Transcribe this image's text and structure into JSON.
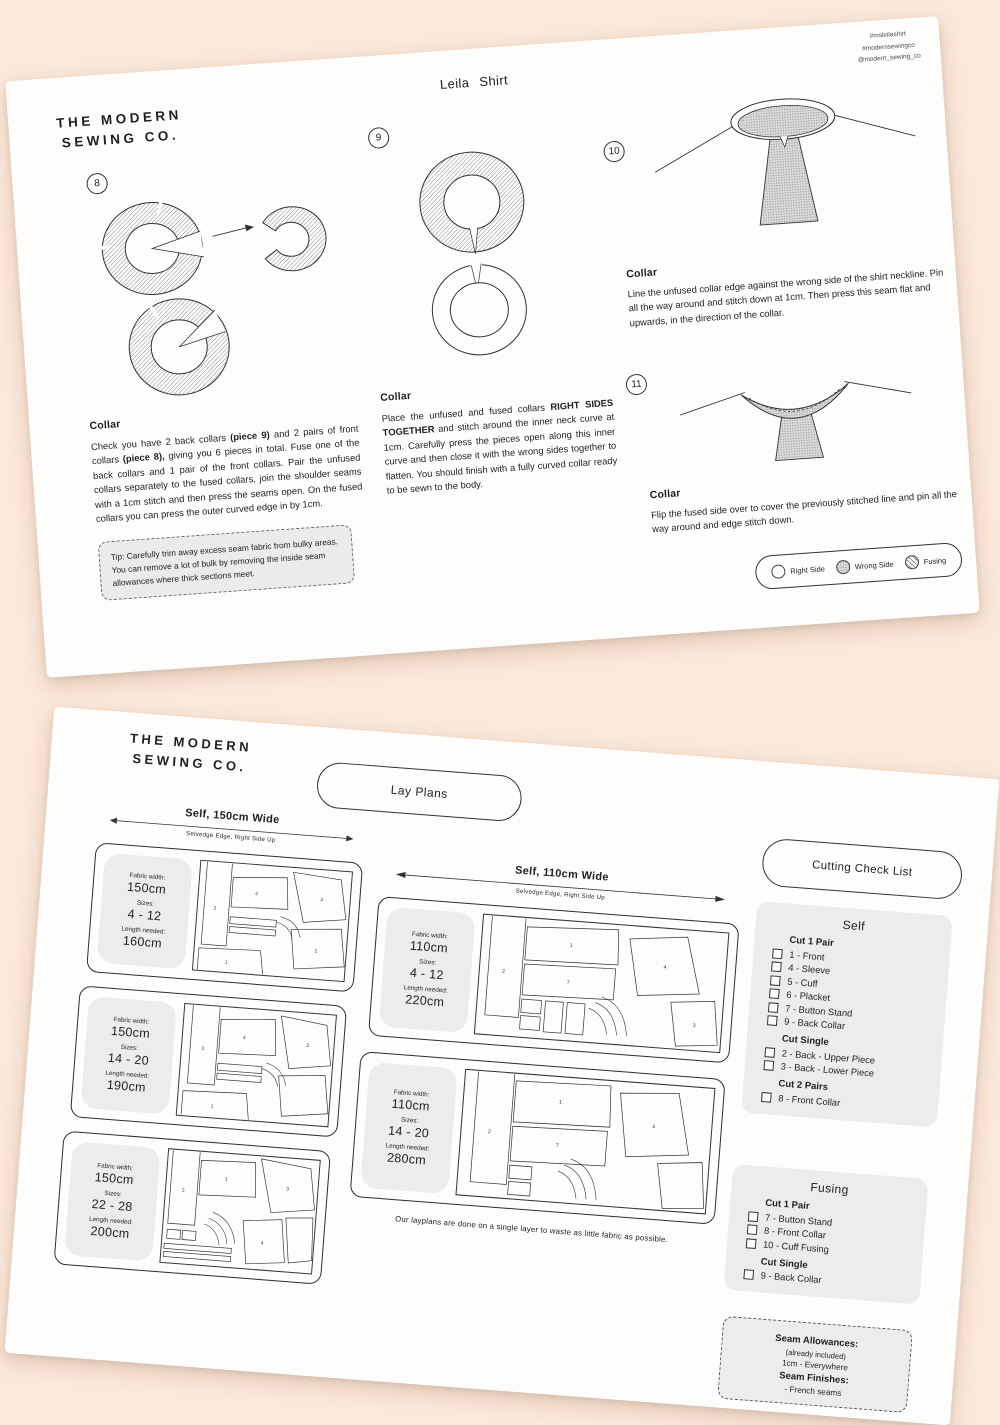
{
  "page1": {
    "social": {
      "l1": "#msleilashirt",
      "l2": "#modernsewingco",
      "l3": "@modern_sewing_co"
    },
    "logo": {
      "line1": "THE MODERN",
      "line2": "SEWING CO."
    },
    "title": "Leila Shirt",
    "steps": {
      "s8": {
        "number": "8",
        "heading": "Collar",
        "t1": "Check you have 2 back collars ",
        "b1": "(piece 9)",
        "t2": " and 2 pairs of front collars ",
        "b2": "(piece 8),",
        "t3": " giving you 6 pieces in total. Fuse one of the back collars and 1 pair of the front collars. Pair the unfused collars separately to the fused collars, join the shoulder seams with a 1cm stitch and then press the seams open. On the fused collars you can press the outer curved edge in by 1cm.",
        "tip": "Tip: Carefully trim away excess seam fabric from bulky areas. You can remove a lot of bulk by removing the inside seam allowances where thick sections meet."
      },
      "s9": {
        "number": "9",
        "heading": "Collar",
        "t1": "Place the unfused and fused collars ",
        "b1": "RIGHT SIDES TOGETHER",
        "t2": " and stitch around the inner neck curve at 1cm. Carefully press the pieces open along this inner curve and then close it with the wrong sides together to flatten. You should finish with a fully curved collar ready to be sewn to the body."
      },
      "s10": {
        "number": "10",
        "heading": "Collar",
        "body": "Line the unfused collar edge against the wrong side of the shirt neckline. Pin all the way around and stitch down at 1cm. Then press this seam flat and upwards, in the direction of the collar."
      },
      "s11": {
        "number": "11",
        "heading": "Collar",
        "body": "Flip the fused side over to cover the previously stitched line and pin all the way around and edge stitch down."
      }
    },
    "legend": {
      "right_side": "Right Side",
      "wrong_side": "Wrong Side",
      "fusing": "Fusing"
    }
  },
  "page2": {
    "logo": {
      "line1": "THE MODERN",
      "line2": "SEWING CO."
    },
    "lay_plans_title": "Lay Plans",
    "headers": {
      "wide150": "Self, 150cm Wide",
      "wide110": "Self, 110cm Wide",
      "selvedge": "Selvedge Edge, Right Side Up"
    },
    "layplans": [
      {
        "fw_label": "Fabric width:",
        "fw": "150cm",
        "sz_label": "Sizes:",
        "sz": "4 - 12",
        "len_label": "Length needed:",
        "len": "160cm",
        "p": [
          "2",
          "4",
          "1",
          "3",
          "5"
        ]
      },
      {
        "fw_label": "Fabric width:",
        "fw": "150cm",
        "sz_label": "Sizes:",
        "sz": "14 - 20",
        "len_label": "Length needed:",
        "len": "190cm",
        "p": [
          "2",
          "4",
          "1",
          "3"
        ]
      },
      {
        "fw_label": "Fabric width:",
        "fw": "150cm",
        "sz_label": "Sizes:",
        "sz": "22 - 28",
        "len_label": "Length needed:",
        "len": "200cm",
        "p": [
          "2",
          "1",
          "3",
          "4"
        ]
      },
      {
        "fw_label": "Fabric width:",
        "fw": "110cm",
        "sz_label": "Sizes:",
        "sz": "4 - 12",
        "len_label": "Length needed:",
        "len": "220cm",
        "p": [
          "2",
          "1",
          "7",
          "4",
          "3"
        ]
      },
      {
        "fw_label": "Fabric width:",
        "fw": "110cm",
        "sz_label": "Sizes:",
        "sz": "14 - 20",
        "len_label": "Length needed:",
        "len": "280cm",
        "p": [
          "2",
          "1",
          "7",
          "4"
        ]
      }
    ],
    "note": "Our layplans are done on a single layer to waste as little fabric as possible.",
    "checklist": {
      "title": "Cutting Check List",
      "self": {
        "title": "Self",
        "g1_heading": "Cut 1 Pair",
        "g1_items": [
          "1 - Front",
          "4 - Sleeve",
          "5 - Cuff",
          "6 - Placket",
          "7 - Button Stand",
          "9 - Back Collar"
        ],
        "g2_heading": "Cut Single",
        "g2_items": [
          "2 - Back - Upper Piece",
          "3 - Back - Lower Piece"
        ],
        "g3_heading": "Cut 2 Pairs",
        "g3_items": [
          "8 - Front Collar"
        ]
      },
      "fusing": {
        "title": "Fusing",
        "g1_heading": "Cut 1 Pair",
        "g1_items": [
          "7 - Button Stand",
          "8 - Front Collar",
          "10 - Cuff Fusing"
        ],
        "g2_heading": "Cut Single",
        "g2_items": [
          "9 - Back Collar"
        ]
      }
    },
    "seam_box": {
      "allowances_title": "Seam Allowances:",
      "allowances_note": "(already included)",
      "allowances_value": "1cm - Everywhere",
      "finishes_title": "Seam Finishes:",
      "finishes_value": "- French seams"
    }
  }
}
